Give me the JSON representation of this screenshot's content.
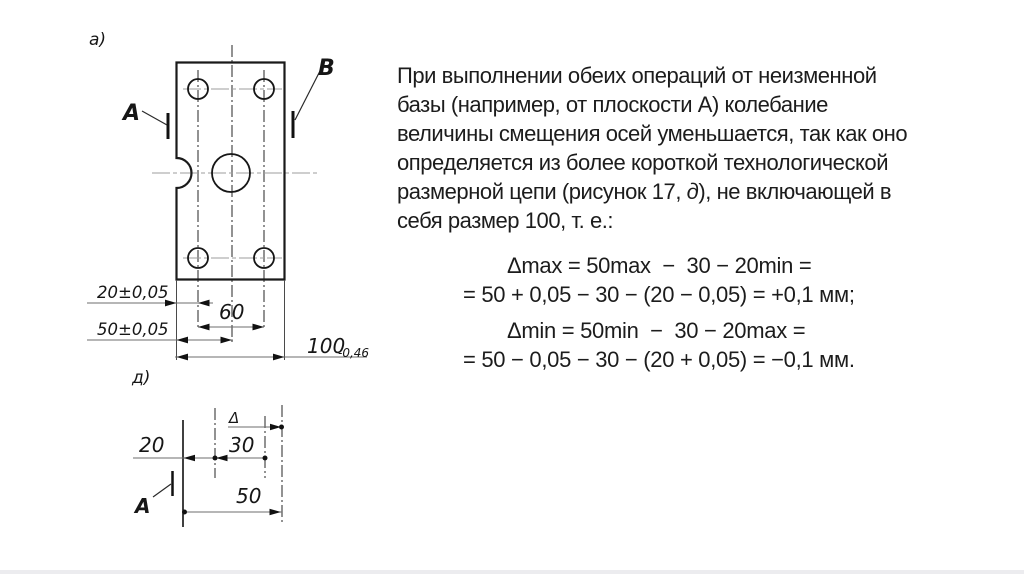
{
  "figure_a": {
    "panel_label": "а)",
    "datum_left": "A",
    "datum_right": "B",
    "dim_20": "20±0,05",
    "dim_50": "50±0,05",
    "dim_60": "60",
    "dim_100_value": "100",
    "dim_100_tolerance": "-0,46"
  },
  "figure_d": {
    "panel_label": "д)",
    "delta_label": "Δ",
    "dim_20": "20",
    "dim_30": "30",
    "dim_50": "50",
    "datum": "A"
  },
  "body_text": {
    "lines": [
      "При выполнении обеих операций от неизменной",
      "базы (например, от плоскости А) колебание",
      "величины смещения осей уменьшается, так как оно",
      "определяется из более короткой технологической"
    ],
    "line5_pre": "размерной цепи (рисунок 17, ",
    "line5_italic": "д",
    "line5_post": "), не включающей в",
    "line6": "себя размер 100, т. е.:"
  },
  "formulas": {
    "line1": "Δmax = 50max  −  30 − 20min =",
    "line2": "= 50 + 0,05 − 30 − (20 − 0,05) = +0,1 мм;",
    "line3": "Δmin = 50min  −  30 − 20max =",
    "line4": "= 50 − 0,05 − 30 − (20 + 0,05) = −0,1 мм."
  }
}
